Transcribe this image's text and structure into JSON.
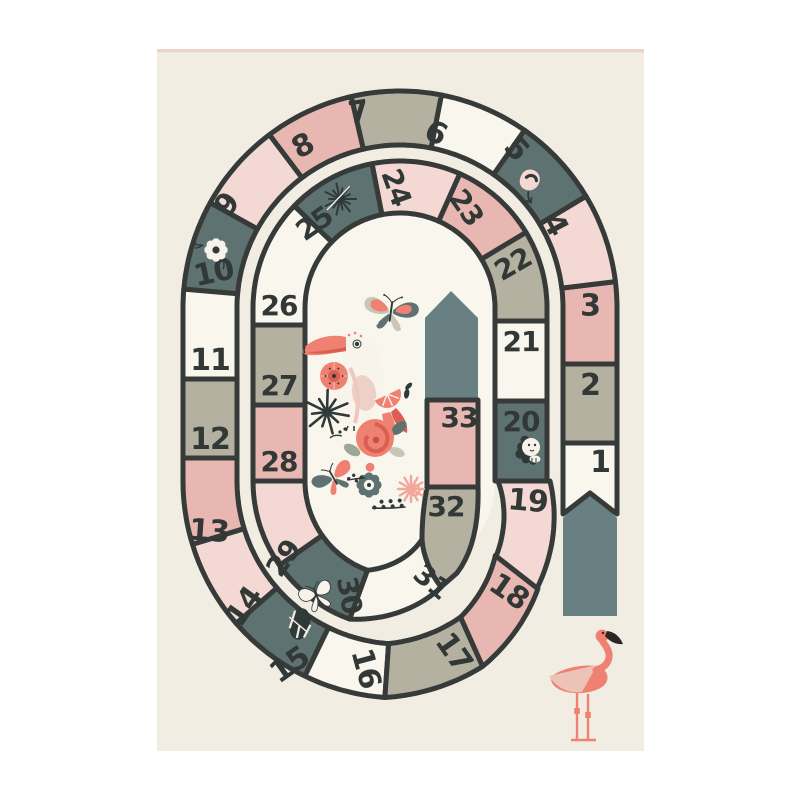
{
  "product": {
    "type": "kids-board-game-play-rug"
  },
  "rug": {
    "bg": "#f1ede2",
    "top_edge": "#eed3cc"
  },
  "palette": {
    "white": "#f9f6ee",
    "sage": "#b4b1a1",
    "pink": "#e9b7b1",
    "lightpink": "#f3d8d3",
    "teal": "#5e7272",
    "teal_marker": "#688081",
    "outline": "#363b3a",
    "number": "#313836",
    "coral": "#ef8172",
    "coral_dark": "#da5f51",
    "wing_pink": "#eec3b7",
    "leaf_dark": "#2f3a38",
    "sage_light": "#c9c6b8",
    "cream": "#f1ede2"
  },
  "board": {
    "cells": [
      {
        "num": 1,
        "color": "white",
        "icon": null
      },
      {
        "num": 2,
        "color": "sage",
        "icon": null
      },
      {
        "num": 3,
        "color": "pink",
        "icon": null
      },
      {
        "num": 4,
        "color": "lightpink",
        "icon": null
      },
      {
        "num": 5,
        "color": "teal",
        "icon": "snail"
      },
      {
        "num": 6,
        "color": "white",
        "icon": null
      },
      {
        "num": 7,
        "color": "sage",
        "icon": null
      },
      {
        "num": 8,
        "color": "pink",
        "icon": null
      },
      {
        "num": 9,
        "color": "lightpink",
        "icon": null
      },
      {
        "num": 10,
        "color": "teal",
        "icon": "flower"
      },
      {
        "num": 11,
        "color": "white",
        "icon": null
      },
      {
        "num": 12,
        "color": "sage",
        "icon": null
      },
      {
        "num": 13,
        "color": "pink",
        "icon": null
      },
      {
        "num": 14,
        "color": "lightpink",
        "icon": null
      },
      {
        "num": 15,
        "color": "teal",
        "icon": "tropical-leaf"
      },
      {
        "num": 16,
        "color": "white",
        "icon": null
      },
      {
        "num": 17,
        "color": "sage",
        "icon": null
      },
      {
        "num": 18,
        "color": "pink",
        "icon": null
      },
      {
        "num": 19,
        "color": "lightpink",
        "icon": null
      },
      {
        "num": 20,
        "color": "teal",
        "icon": "lion"
      },
      {
        "num": 21,
        "color": "white",
        "icon": null
      },
      {
        "num": 22,
        "color": "sage",
        "icon": null
      },
      {
        "num": 23,
        "color": "pink",
        "icon": null
      },
      {
        "num": 24,
        "color": "lightpink",
        "icon": null
      },
      {
        "num": 25,
        "color": "teal",
        "icon": "dandelion"
      },
      {
        "num": 26,
        "color": "white",
        "icon": null
      },
      {
        "num": 27,
        "color": "sage",
        "icon": null
      },
      {
        "num": 28,
        "color": "pink",
        "icon": null
      },
      {
        "num": 29,
        "color": "lightpink",
        "icon": null
      },
      {
        "num": 30,
        "color": "teal",
        "icon": "butterfly-white"
      },
      {
        "num": 31,
        "color": "white",
        "icon": null
      },
      {
        "num": 32,
        "color": "sage",
        "icon": null
      },
      {
        "num": 33,
        "color": "pink",
        "icon": null
      }
    ],
    "start_marker": {
      "icon": "up-arrow",
      "color": "teal_marker"
    },
    "finish_marker": {
      "icon": "up-arrow-house",
      "color": "teal_marker"
    }
  },
  "center_illustration": {
    "items": [
      "butterfly",
      "toucan",
      "poppy-flower",
      "palm-leaf",
      "orange-slice",
      "rose",
      "teal-flower",
      "pink-starburst",
      "butterfly",
      "laurel-sprig"
    ]
  },
  "corner_illustration": {
    "item": "flamingo"
  }
}
